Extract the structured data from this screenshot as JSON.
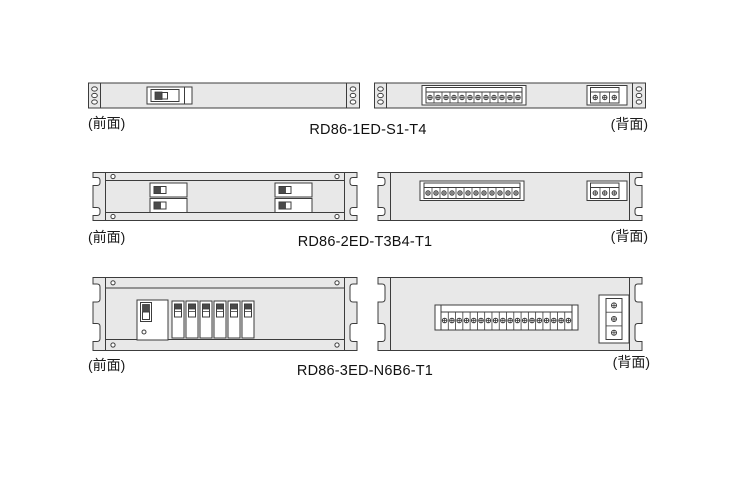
{
  "colors": {
    "background": "#ffffff",
    "panel_fill": "#e8e8e8",
    "outline": "#3c3c3c",
    "component_fill": "#ffffff",
    "toggle_dark": "#4a4a4a"
  },
  "units": [
    {
      "model": "RD86-1ED-S1-T4",
      "front_label": "(前面)",
      "back_label": "(背面)",
      "front": {
        "rack_height": "1U",
        "switches": 1,
        "ear_holes_per_side": 3
      },
      "back": {
        "main_terminals": 12,
        "aux_terminals": 3,
        "ear_holes_per_side": 3
      }
    },
    {
      "model": "RD86-2ED-T3B4-T1",
      "front_label": "(前面)",
      "back_label": "(背面)",
      "front": {
        "rack_height": "2U",
        "switch_pairs": 2,
        "corner_screws": 4,
        "ear_slots_per_side": 2
      },
      "back": {
        "main_terminals": 12,
        "aux_terminals": 3,
        "ear_slots_per_side": 2
      }
    },
    {
      "model": "RD86-3ED-N6B6-T1",
      "front_label": "(前面)",
      "back_label": "(背面)",
      "front": {
        "rack_height": "3U",
        "main_breakers": 1,
        "branch_breakers": 6,
        "corner_screws": 4,
        "ear_slots_per_side": 2
      },
      "back": {
        "main_terminals": 18,
        "aux_terminals": 3,
        "ear_slots_per_side": 2
      }
    }
  ]
}
